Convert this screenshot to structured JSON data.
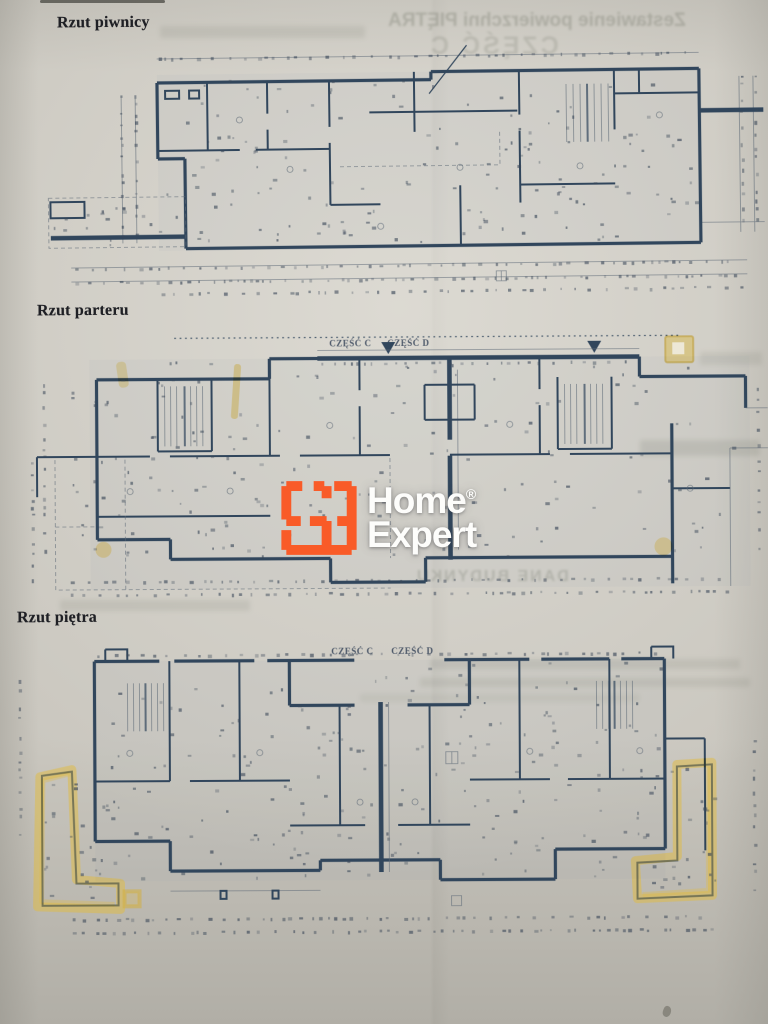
{
  "titles": {
    "basement": "Rzut piwnicy",
    "ground": "Rzut parteru",
    "first": "Rzut piętra"
  },
  "section_labels": {
    "part_c": "CZĘŚĆ C",
    "part_d": "CZĘŚĆ D"
  },
  "logo": {
    "line1": "Home",
    "registered": "®",
    "line2": "Expert"
  },
  "ghost_text": {
    "top_line": "Zestawienie powierzchni PIĘTRA",
    "top_line2": "CZĘŚĆ C",
    "middle_line": "DANE BUDYNKU"
  },
  "colors": {
    "paper": "#cac7bf",
    "wall": "#31465c",
    "thin": "#5f6b77",
    "highlight": "#d9b94b",
    "logo_orange": "#f95b28",
    "logo_text": "#fdfdfb",
    "title_ink": "#1f2025",
    "ghost_ink": "#74776a"
  }
}
